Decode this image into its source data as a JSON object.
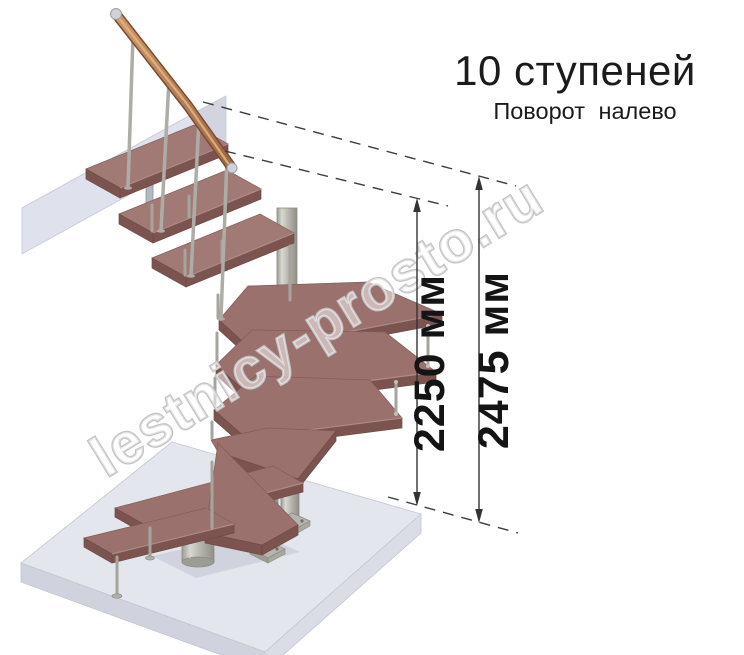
{
  "title": {
    "text": "10 ступеней",
    "subtitle": "Поворот налево"
  },
  "dimensions": {
    "inner": {
      "value": 2250,
      "unit": "мм",
      "label": "2250 мм"
    },
    "outer": {
      "value": 2475,
      "unit": "мм",
      "label": "2475 мм"
    }
  },
  "watermark": {
    "text": "lestnicy-prosto.ru"
  },
  "structure": {
    "steps_total": 10,
    "turn_direction": "налево",
    "type": "модульная лестница с забежными ступенями"
  },
  "colors": {
    "wood_top": "#9a716d",
    "wood_edge": "#7b534f",
    "metal": "#b0b0a8",
    "slab": "#e4e6ee",
    "dimension_line": "#333333",
    "watermark_stroke": "#c3c3c3",
    "background": "#ffffff"
  }
}
